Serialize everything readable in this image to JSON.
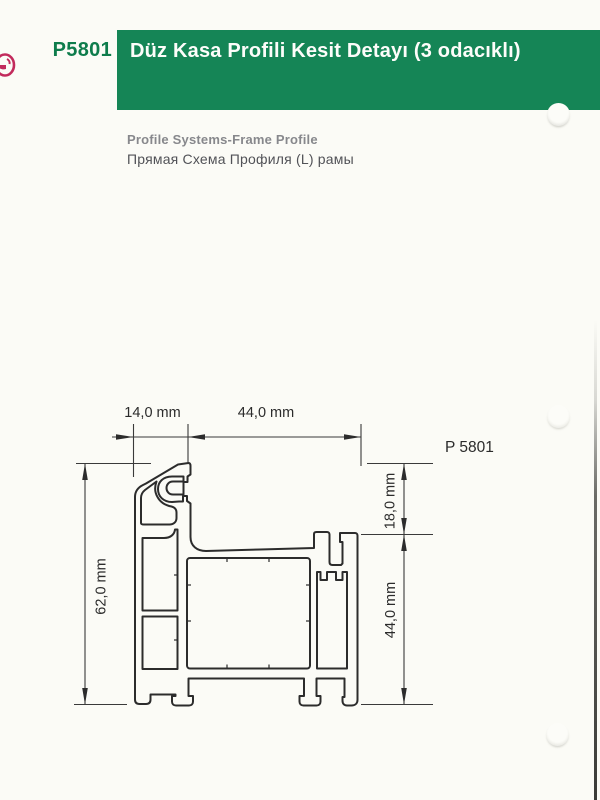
{
  "header": {
    "code": "P5801",
    "title": "Düz Kasa Profili Kesit Detayı (3 odacıklı)"
  },
  "subtitle": {
    "english": "Profile Systems-Frame Profile",
    "russian": "Прямая Схема Профиля (L) рамы"
  },
  "drawing": {
    "part_label": "P 5801",
    "dimensions": {
      "width_left": "14,0 mm",
      "width_main": "44,0 mm",
      "height_total": "62,0 mm",
      "height_top": "18,0 mm",
      "height_main": "44,0 mm"
    }
  },
  "colors": {
    "band_green": "#158556",
    "code_green": "#0e7c4c",
    "logo_crimson": "#c22a5c",
    "line_dark": "#2c2c2c"
  }
}
